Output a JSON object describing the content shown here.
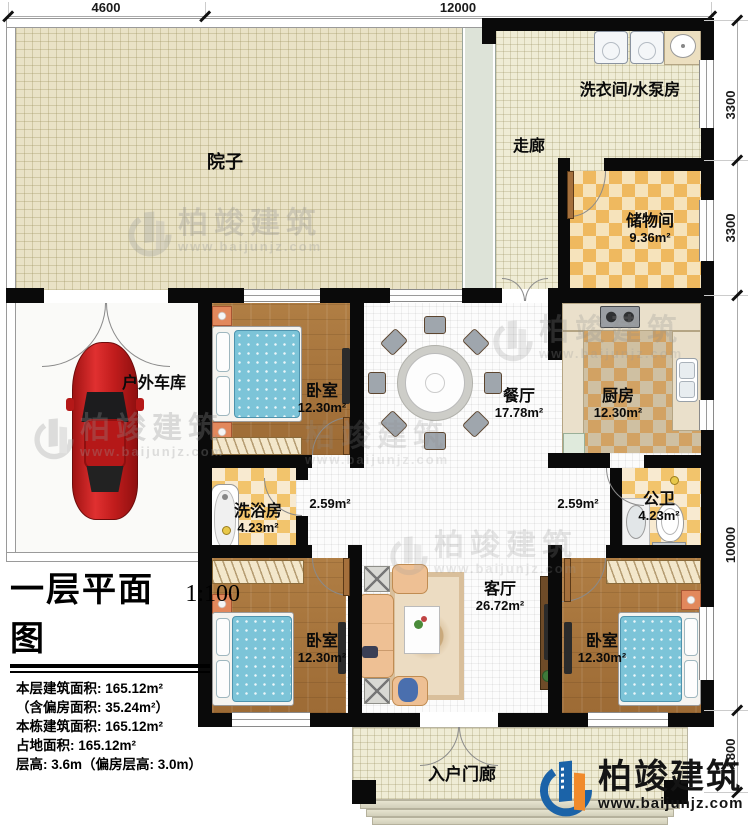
{
  "dimensions": {
    "top": [
      "4600",
      "12000"
    ],
    "right": [
      "3300",
      "3300",
      "10000",
      "1800"
    ]
  },
  "rooms": {
    "yard": {
      "label": "院子"
    },
    "corridor": {
      "label": "走廊"
    },
    "laundry": {
      "label": "洗衣间/水泵房"
    },
    "storage": {
      "label": "储物间",
      "area": "9.36m²"
    },
    "garage": {
      "label": "户外车库"
    },
    "bedroom_top": {
      "label": "卧室",
      "area": "12.30m²"
    },
    "dining": {
      "label": "餐厅",
      "area": "17.78m²"
    },
    "kitchen": {
      "label": "厨房",
      "area": "12.30m²"
    },
    "shower": {
      "label": "洗浴房",
      "area": "4.23m²"
    },
    "wc": {
      "label": "公卫",
      "area": "4.23m²"
    },
    "hall_left": {
      "area": "2.59m²"
    },
    "hall_right": {
      "area": "2.59m²"
    },
    "living": {
      "label": "客厅",
      "area": "26.72m²"
    },
    "bedroom_left": {
      "label": "卧室",
      "area": "12.30m²"
    },
    "bedroom_right": {
      "label": "卧室",
      "area": "12.30m²"
    },
    "porch": {
      "label": "入户门廊"
    }
  },
  "title_block": {
    "title": "一层平面图",
    "scale": "1:100",
    "stats": [
      "本层建筑面积: 165.12m²",
      "（含偏房面积: 35.24m²）",
      "本栋建筑面积: 165.12m²",
      "占地面积: 165.12m²",
      "层高: 3.6m（偏房层高: 3.0m）"
    ]
  },
  "branding": {
    "company": "柏竣建筑",
    "website": "www.baijunjz.com"
  },
  "colors": {
    "wall": "#0a0a0a",
    "wood_floor": "#a9743c",
    "checker_orange": "#efb95f",
    "bed_blue": "#7cc4d8",
    "car_red": "#c51f1f",
    "logo_blue": "#1b63a8",
    "logo_orange": "#f08a2b"
  }
}
